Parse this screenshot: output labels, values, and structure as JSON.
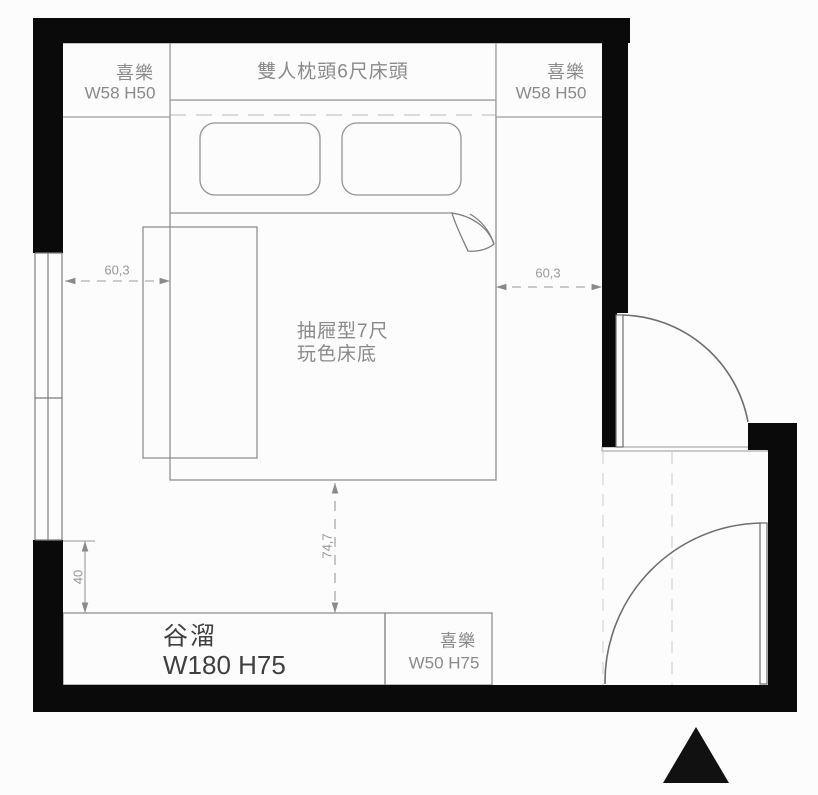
{
  "title": "bedroom furniture floor plan",
  "colors": {
    "wall": "#0a0a0a",
    "furniture_line": "#8f8f8f",
    "hidden_line": "#cccccc",
    "label_gray": "#8a8a8a",
    "label_dark": "#3f3f3f",
    "background": "#fcfcfc"
  },
  "furniture": {
    "cabinet_top_left": {
      "name": "喜樂",
      "size": "W58 H50"
    },
    "headboard": {
      "label": "雙人枕頭6尺床頭"
    },
    "cabinet_top_right": {
      "name": "喜樂",
      "size": "W58 H50"
    },
    "bed_base": {
      "line1": "抽屜型7尺",
      "line2": "玩色床底"
    },
    "cabinet_bottom": {
      "name": "谷溜",
      "size": "W180 H75"
    },
    "cabinet_bottom_right": {
      "name": "喜樂",
      "size": "W50 H75"
    }
  },
  "dimensions": {
    "gap_left": "60,3",
    "gap_right": "60,3",
    "gap_bottom": "74,7",
    "gap_wall": "40"
  }
}
